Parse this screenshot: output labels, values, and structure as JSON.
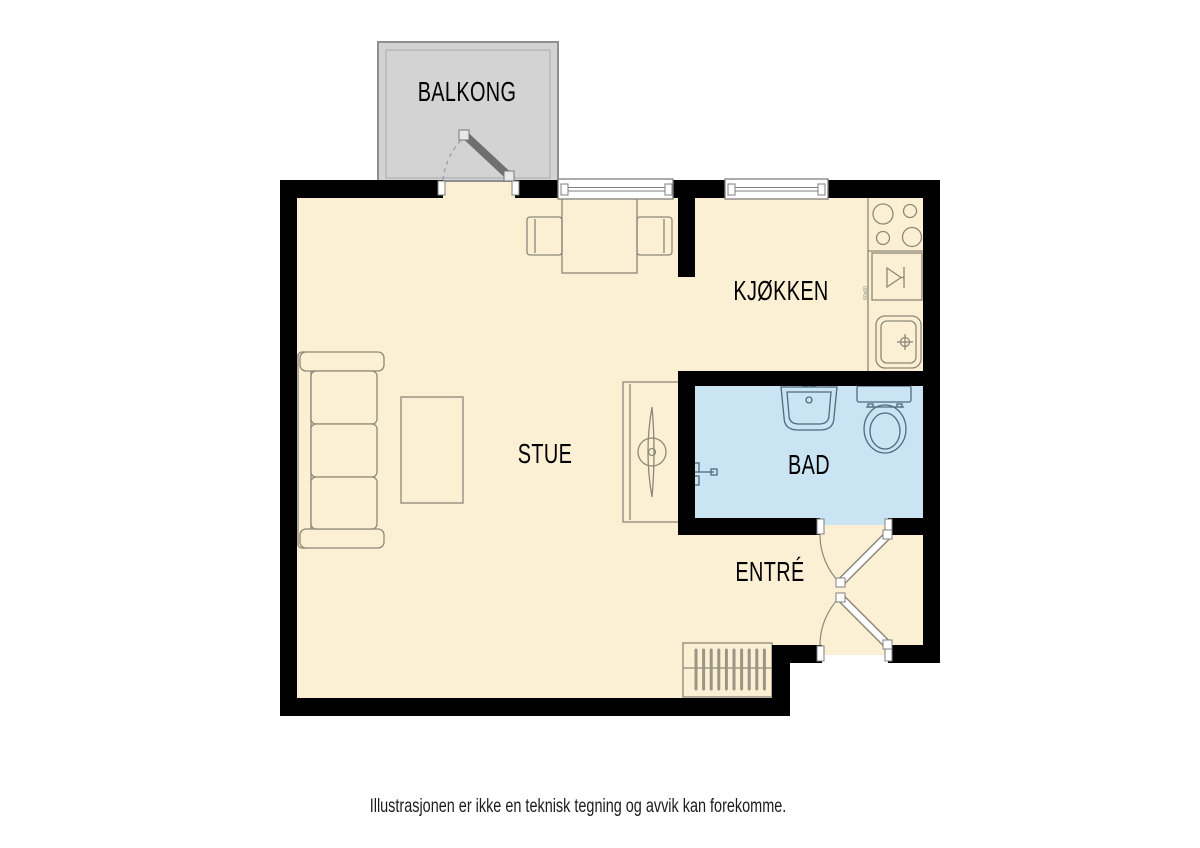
{
  "rooms": {
    "balcony": {
      "label": "BALKONG"
    },
    "kitchen": {
      "label": "KJØKKEN"
    },
    "living_room by": {
      "label": ""
    },
    "living": {
      "label": "STUE"
    },
    "bathroom": {
      "label": "BAD"
    },
    "entrance": {
      "label": "ENTRÉ"
    }
  },
  "annotations": {
    "dishwasher_size": "60x60"
  },
  "footer": {
    "disclaimer": "Illustrasjonen er ikke en teknisk tegning og avvik kan forekomme."
  },
  "colors": {
    "floor": "#FBF0D3",
    "bathroom_floor": "#CBE4F3",
    "balcony_floor": "#D3D3D3",
    "wall": "#000000",
    "furniture_outline": "#8D8878",
    "fixture_outline": "#4E6B7C",
    "window_frame": "#7F7F7F",
    "balcony_door_leaf": "#6F6F6F",
    "caption_text": "#1C1C1C"
  }
}
